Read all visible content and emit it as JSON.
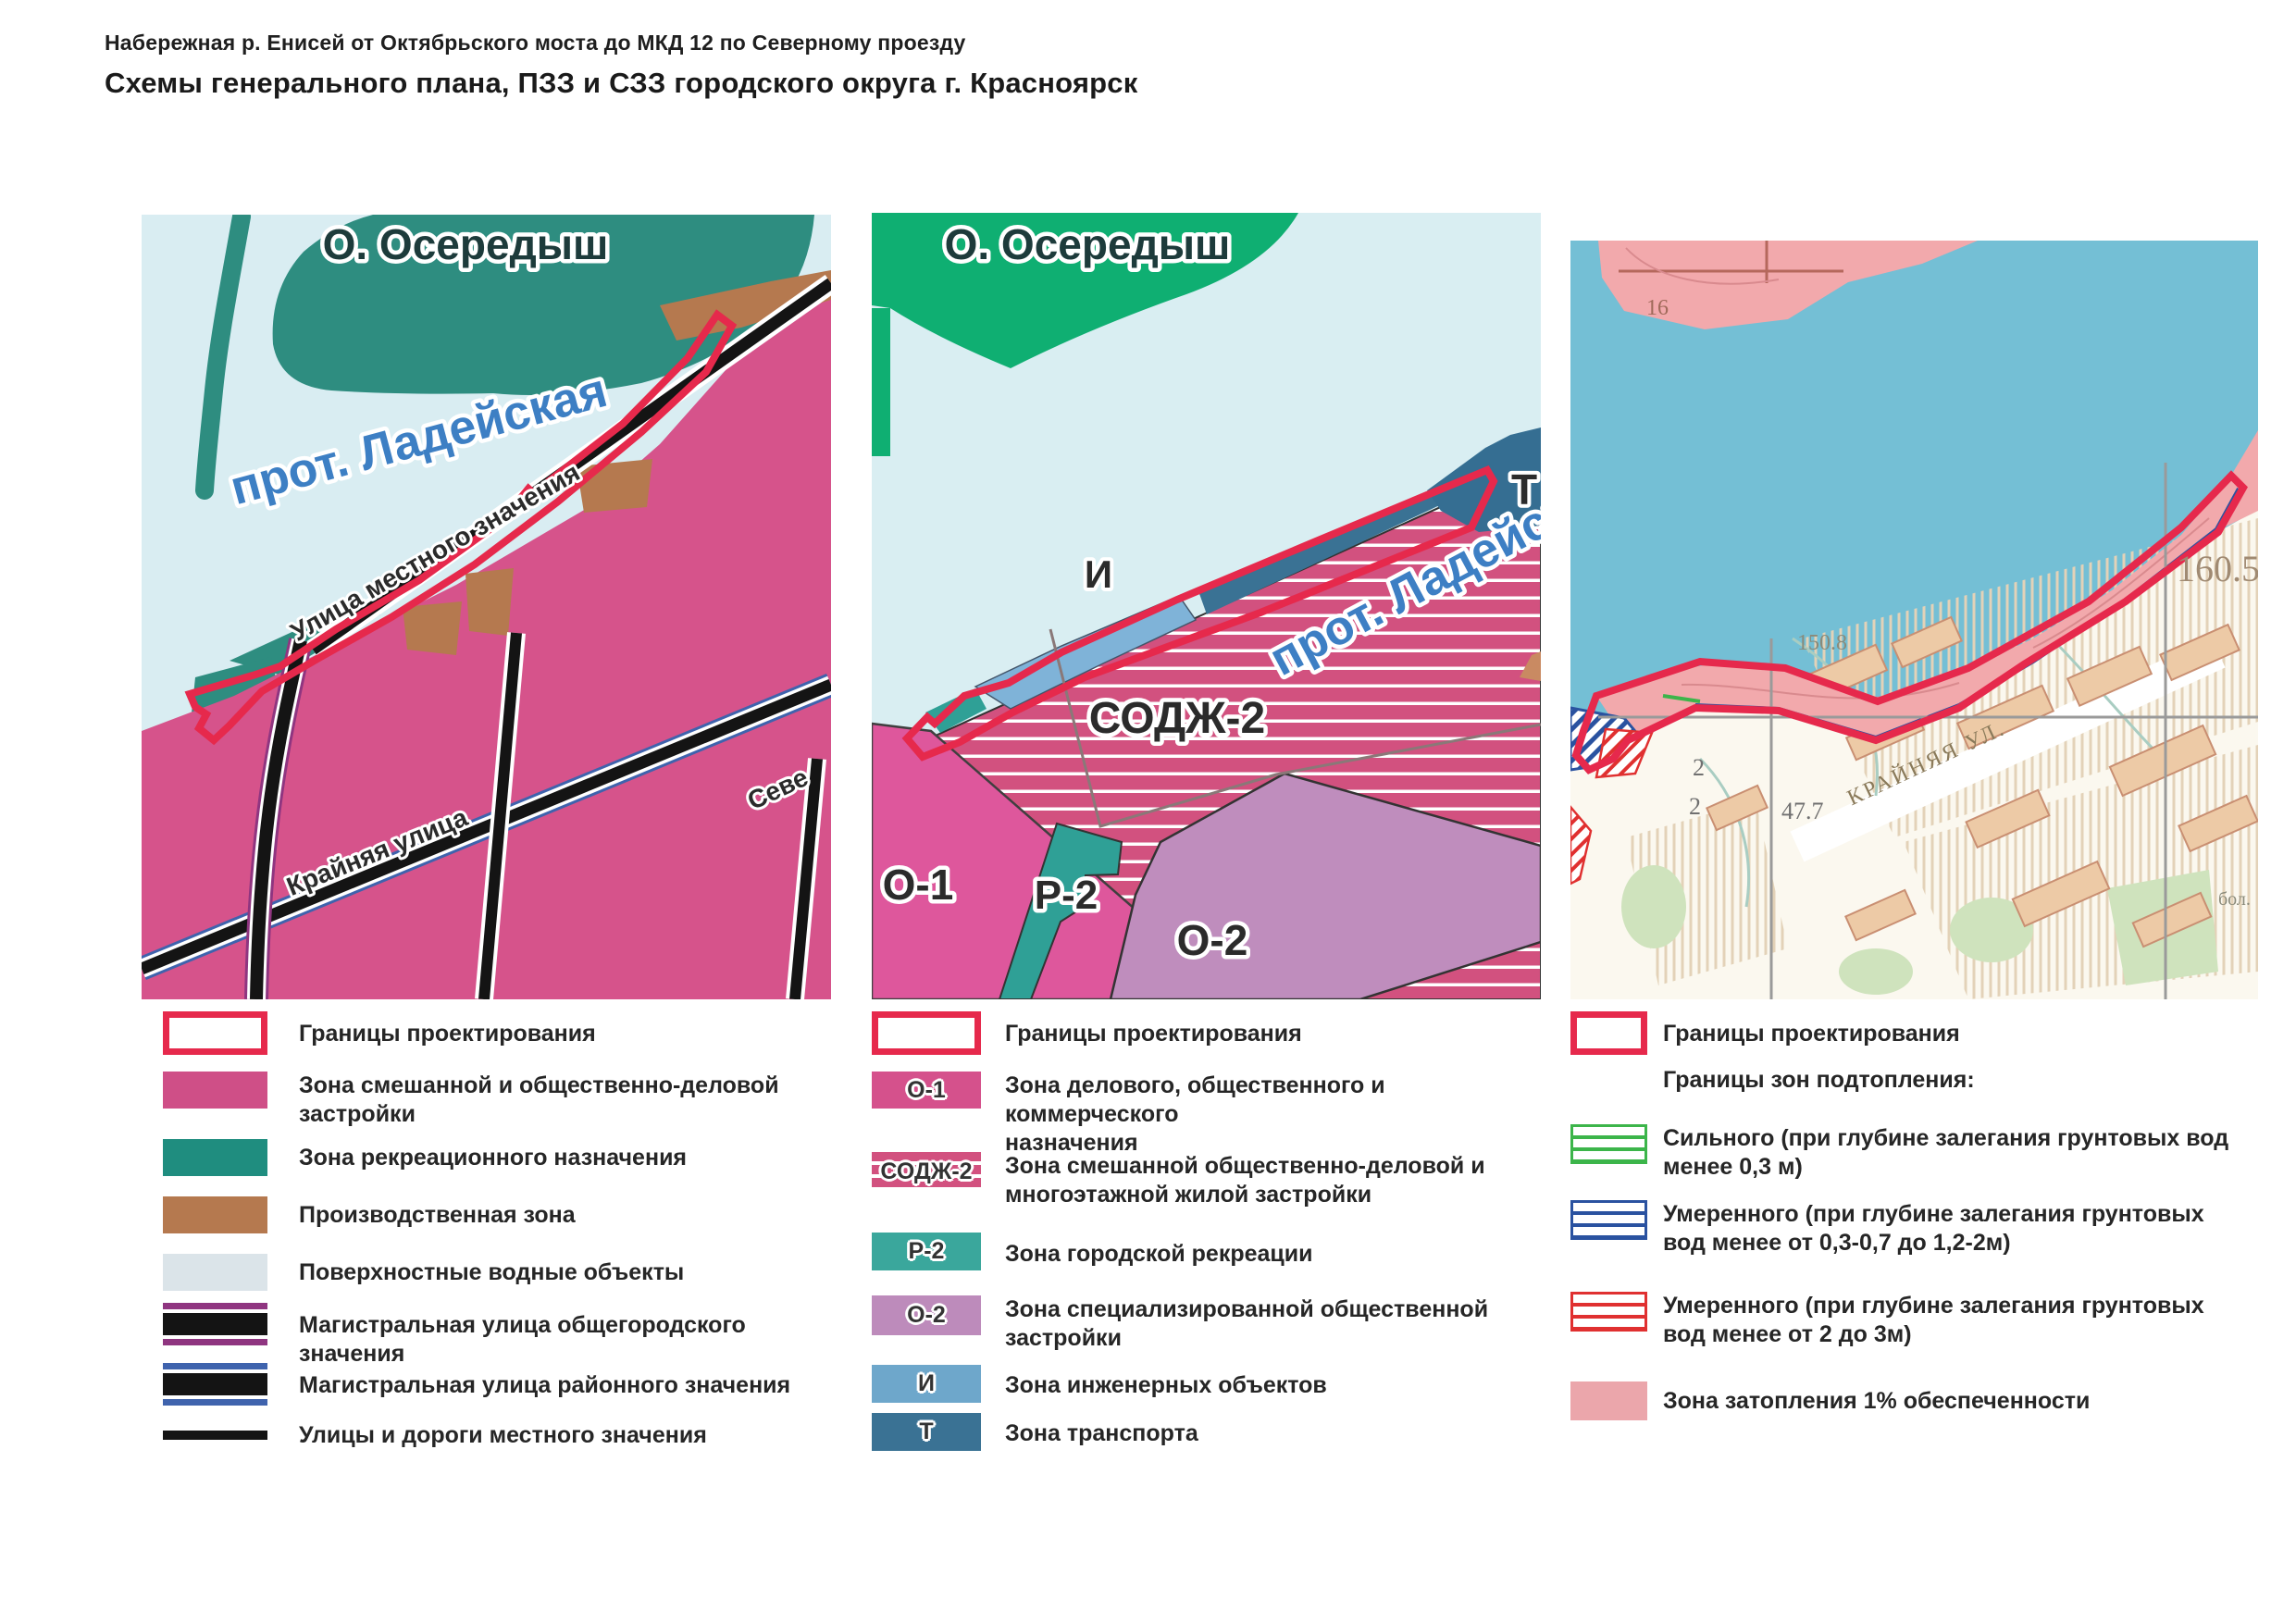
{
  "page": {
    "header": "Набережная р. Енисей от Октябрьского моста до МКД 12 по Северному проезду",
    "title": "Схемы генерального плана, ПЗЗ и СЗЗ городского округа г. Красноярск"
  },
  "palette": {
    "boundary_red": "#e6294c",
    "water_light": "#d9edf2",
    "water_topo": "#74bfd5",
    "mixed_pink": "#cf4f87",
    "recreation_teal": "#1f8d7f",
    "industry_brown": "#b5794f",
    "surface_water_gray": "#dbe4e9",
    "road_city_purple": "#8f3580",
    "road_district_blue": "#3f63ad",
    "island_green": "#0faf72",
    "flood_pink": "#eba6ab",
    "hatch_green": "#3cb54a",
    "hatch_blue": "#2a52a0",
    "hatch_red": "#e03030"
  },
  "maps": {
    "genplan": {
      "island": "О. Осередыш",
      "channel": "прот. Ладейская",
      "street_shore": "Улица местного значения",
      "street_kraynyaya": "Крайняя улица",
      "street_severny": "Севе"
    },
    "pzz": {
      "island": "О. Осередыш",
      "channel": "прот. Ладейская",
      "zone_i": "И",
      "zone_t": "Т",
      "zone_sodzh": "СОДЖ-2",
      "zone_o1": "О-1",
      "zone_r2": "Р-2",
      "zone_o2": "О-2"
    },
    "szz": {
      "elev_160": "160.5",
      "elev_150": "150.8",
      "elev_47": "47.7",
      "street": "КРАЙНЯЯ УЛ.",
      "mark_16": "16",
      "mark_2a": "2",
      "mark_2b": "2",
      "mark_bol": "бол."
    }
  },
  "legend_genplan": {
    "items": [
      {
        "label": "Границы проектирования",
        "type": "boundary",
        "color": "#e6294c"
      },
      {
        "label": "Зона смешанной и общественно-деловой\nзастройки",
        "type": "solid",
        "color": "#cf4f87"
      },
      {
        "label": "Зона рекреационного назначения",
        "type": "solid",
        "color": "#1f8d7f"
      },
      {
        "label": "Производственная зона",
        "type": "solid",
        "color": "#b5794f"
      },
      {
        "label": "Поверхностные водные объекты",
        "type": "solid",
        "color": "#dbe4e9"
      },
      {
        "label": "Магистральная улица общегородского значения",
        "type": "road",
        "color": "#8f3580"
      },
      {
        "label": "Магистральная улица районного значения",
        "type": "road",
        "color": "#3f63ad"
      },
      {
        "label": "Улицы и дороги местного значения",
        "type": "line",
        "color": "#141414"
      }
    ]
  },
  "legend_pzz": {
    "items": [
      {
        "code": "",
        "label": "Границы проектирования",
        "type": "boundary",
        "color": "#e6294c"
      },
      {
        "code": "О-1",
        "label": "Зона делового, общественного и коммерческого\nназначения",
        "type": "solid",
        "color": "#d5518c"
      },
      {
        "code": "СОДЖ-2",
        "label": "Зона смешанной общественно-деловой и\nмногоэтажной жилой застройки",
        "type": "striped",
        "color": "#d2517f"
      },
      {
        "code": "Р-2",
        "label": "Зона городской рекреации",
        "type": "solid",
        "color": "#3aa79c"
      },
      {
        "code": "О-2",
        "label": "Зона специализированной общественной\nзастройки",
        "type": "solid",
        "color": "#bd8bbb"
      },
      {
        "code": "И",
        "label": "Зона инженерных объектов",
        "type": "solid",
        "color": "#6ea7cb"
      },
      {
        "code": "Т",
        "label": "Зона транспорта",
        "type": "solid",
        "color": "#3a7294"
      }
    ]
  },
  "legend_szz": {
    "subheader": "Границы зон подтопления:",
    "items": [
      {
        "label": "Границы проектирования",
        "type": "boundary",
        "color": "#e6294c"
      },
      {
        "label": "Сильного (при глубине залегания грунтовых вод\nменее 0,3 м)",
        "type": "hatch",
        "color": "#3cb54a"
      },
      {
        "label": "Умеренного (при глубине залегания грунтовых\nвод менее от 0,3-0,7 до 1,2-2м)",
        "type": "hatch",
        "color": "#2a52a0"
      },
      {
        "label": "Умеренного (при глубине залегания грунтовых\nвод менее от 2 до 3м)",
        "type": "hatch",
        "color": "#e03030"
      },
      {
        "label": "Зона затопления 1% обеспеченности",
        "type": "solid",
        "color": "#eba6ab"
      }
    ]
  }
}
